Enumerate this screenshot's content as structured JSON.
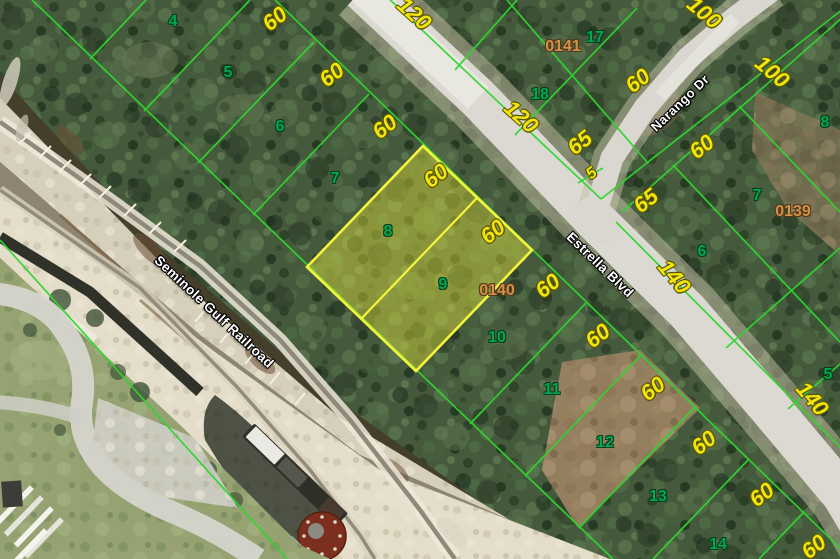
{
  "map_type": "aerial-parcel-map",
  "highlighted_lots": [
    "8",
    "9"
  ],
  "colors": {
    "lot_line": "#2fd52f",
    "highlight_border": "#f4f43c",
    "highlight_fill": "#e8e83c",
    "dimension_text": "#f2e50c",
    "lot_number_text": "#00a84f",
    "plat_number_text": "#d2914a",
    "street_text": "#ffffff"
  },
  "streets": [
    {
      "name": "Estrella Blvd",
      "x": 600,
      "y": 265,
      "rot": 44,
      "size": 13.5
    },
    {
      "name": "Narango Dr",
      "x": 680,
      "y": 103,
      "rot": -44,
      "size": 13
    },
    {
      "name": "Seminole Gulf Railroad",
      "x": 214,
      "y": 312,
      "rot": 43,
      "size": 13.5
    }
  ],
  "lot_numbers": [
    {
      "text": "4",
      "x": 173,
      "y": 22
    },
    {
      "text": "5",
      "x": 228,
      "y": 73
    },
    {
      "text": "6",
      "x": 280,
      "y": 127
    },
    {
      "text": "7",
      "x": 335,
      "y": 179
    },
    {
      "text": "8",
      "x": 388,
      "y": 232
    },
    {
      "text": "9",
      "x": 443,
      "y": 285
    },
    {
      "text": "10",
      "x": 497,
      "y": 338
    },
    {
      "text": "11",
      "x": 552,
      "y": 390
    },
    {
      "text": "12",
      "x": 605,
      "y": 443
    },
    {
      "text": "13",
      "x": 658,
      "y": 497
    },
    {
      "text": "14",
      "x": 718,
      "y": 545
    },
    {
      "text": "17",
      "x": 595,
      "y": 38
    },
    {
      "text": "18",
      "x": 540,
      "y": 95
    },
    {
      "text": "8",
      "x": 825,
      "y": 123
    },
    {
      "text": "7",
      "x": 757,
      "y": 196
    },
    {
      "text": "6",
      "x": 702,
      "y": 252
    },
    {
      "text": "5",
      "x": 828,
      "y": 375
    }
  ],
  "dimensions": [
    {
      "text": "60",
      "x": 233,
      "y": -12,
      "rot": -38
    },
    {
      "text": "60",
      "x": 275,
      "y": 19,
      "rot": -38
    },
    {
      "text": "60",
      "x": 332,
      "y": 75,
      "rot": -38
    },
    {
      "text": "60",
      "x": 385,
      "y": 127,
      "rot": -38
    },
    {
      "text": "60",
      "x": 436,
      "y": 176,
      "rot": -38
    },
    {
      "text": "60",
      "x": 493,
      "y": 232,
      "rot": -38
    },
    {
      "text": "60",
      "x": 548,
      "y": 286,
      "rot": -38
    },
    {
      "text": "60",
      "x": 598,
      "y": 336,
      "rot": -38
    },
    {
      "text": "60",
      "x": 653,
      "y": 389,
      "rot": -38
    },
    {
      "text": "60",
      "x": 704,
      "y": 443,
      "rot": -38
    },
    {
      "text": "60",
      "x": 762,
      "y": 495,
      "rot": -38
    },
    {
      "text": "60",
      "x": 814,
      "y": 547,
      "rot": -38
    },
    {
      "text": "60",
      "x": 638,
      "y": 81,
      "rot": -38
    },
    {
      "text": "60",
      "x": 702,
      "y": 147,
      "rot": -38
    },
    {
      "text": "120",
      "x": 414,
      "y": 14,
      "rot": 42
    },
    {
      "text": "120",
      "x": 521,
      "y": 117,
      "rot": 42
    },
    {
      "text": "100",
      "x": 704,
      "y": 13,
      "rot": 40
    },
    {
      "text": "100",
      "x": 772,
      "y": 72,
      "rot": 40
    },
    {
      "text": "140",
      "x": 674,
      "y": 277,
      "rot": 50
    },
    {
      "text": "140",
      "x": 812,
      "y": 399,
      "rot": 50
    },
    {
      "text": "65",
      "x": 580,
      "y": 143,
      "rot": -38
    },
    {
      "text": "65",
      "x": 646,
      "y": 201,
      "rot": -38
    },
    {
      "text": "5",
      "x": 592,
      "y": 174,
      "rot": -38,
      "small": true
    }
  ],
  "plat_numbers": [
    {
      "text": "0141",
      "x": 563,
      "y": 47
    },
    {
      "text": "0140",
      "x": 497,
      "y": 291
    },
    {
      "text": "0139",
      "x": 793,
      "y": 212
    }
  ]
}
